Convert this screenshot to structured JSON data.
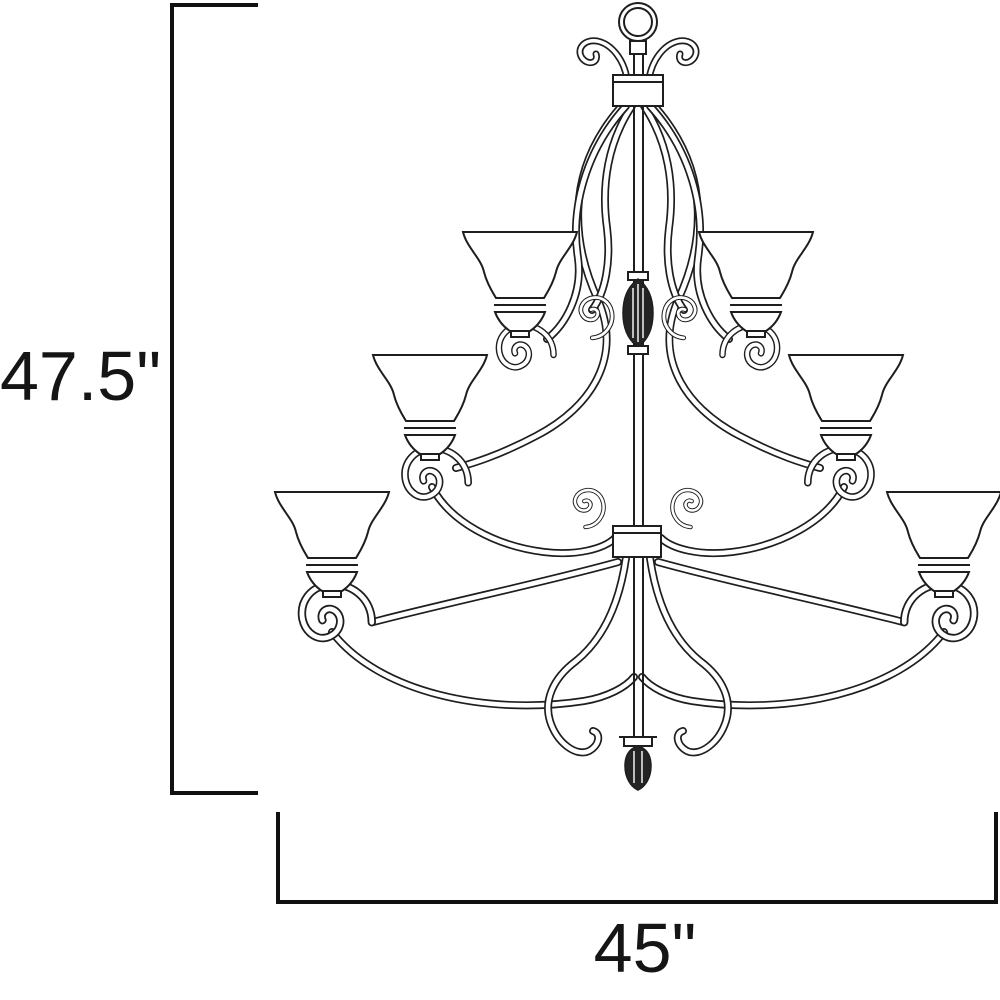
{
  "diagram": {
    "title": "chandelier dimension drawing",
    "height_dimension": {
      "label": "47.5\""
    },
    "width_dimension": {
      "label": "45\""
    },
    "figure": {
      "type": "line-drawing",
      "subject": "three-tier scrolled-arm chandelier",
      "tiers": 3,
      "visible_shades": 6
    },
    "style": {
      "line_color": "#1e1e1e",
      "dimension_color": "#111111",
      "background": "#ffffff"
    }
  }
}
